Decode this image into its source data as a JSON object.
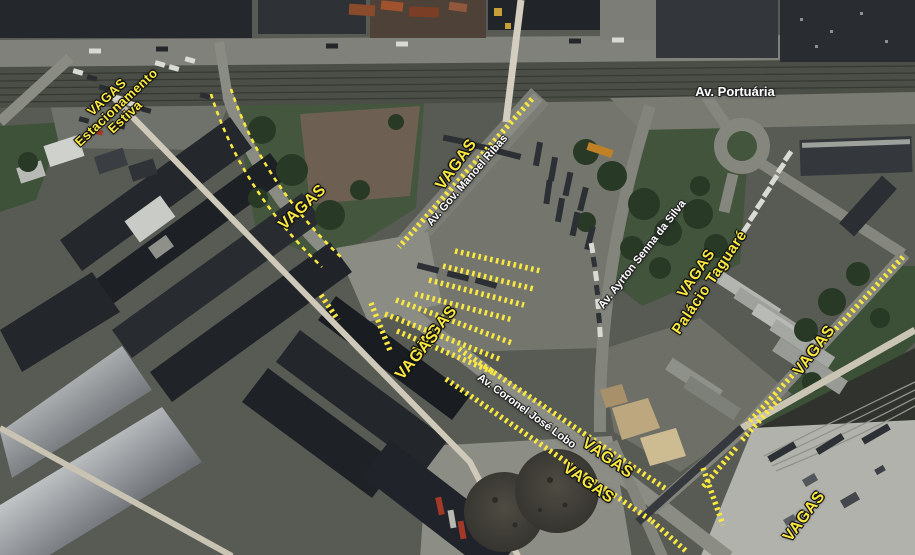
{
  "map": {
    "annotation_color": "#f9e840",
    "street_label_color": "#ffffff",
    "street_labels": [
      {
        "text": "Av. Portuária",
        "x": 735,
        "y": 92,
        "rot": 0,
        "size": 13
      },
      {
        "text": "Av. Gov. Manoel Ribas",
        "x": 468,
        "y": 181,
        "rot": -49,
        "size": 11
      },
      {
        "text": "Av. Ayrton Senna da Silva",
        "x": 643,
        "y": 255,
        "rot": -52,
        "size": 11
      },
      {
        "text": "Av. Coronel José Lobo",
        "x": 526,
        "y": 412,
        "rot": 36,
        "size": 11
      }
    ],
    "vagas_labels": [
      {
        "text": "VAGAS\nEstacionamento\nEstiva",
        "x": 116,
        "y": 107,
        "rot": -43,
        "size": 13
      },
      {
        "text": "VAGAS",
        "x": 303,
        "y": 208,
        "rot": -43,
        "size": 16
      },
      {
        "text": "VAGAS",
        "x": 457,
        "y": 165,
        "rot": -54,
        "size": 16
      },
      {
        "text": "VAGAS\nPalácio Taguaré",
        "x": 703,
        "y": 278,
        "rot": -56,
        "size": 15
      },
      {
        "text": "VAGAS",
        "x": 436,
        "y": 331,
        "rot": -50,
        "size": 16
      },
      {
        "text": "VAGAS",
        "x": 418,
        "y": 356,
        "rot": -50,
        "size": 16
      },
      {
        "text": "VAGAS",
        "x": 607,
        "y": 459,
        "rot": 35,
        "size": 16
      },
      {
        "text": "VAGAS",
        "x": 588,
        "y": 484,
        "rot": 35,
        "size": 16
      },
      {
        "text": "VAGAS",
        "x": 815,
        "y": 351,
        "rot": -53,
        "size": 16
      },
      {
        "text": "VAGAS",
        "x": 805,
        "y": 517,
        "rot": -53,
        "size": 16
      }
    ]
  }
}
